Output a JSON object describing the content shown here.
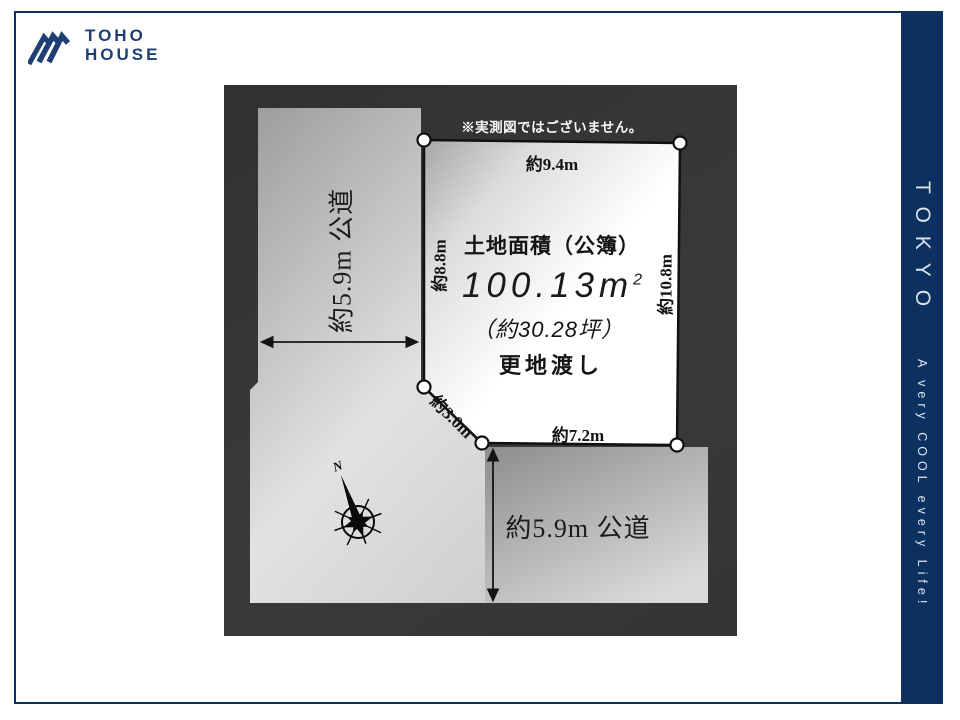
{
  "page": {
    "brand": {
      "name_line1": "TOHO",
      "name_line2": "HOUSE"
    },
    "side_band": {
      "title": "TOKYO",
      "tagline": "A very COOL every Life!"
    },
    "colors": {
      "navy_band": "#0c3060",
      "logo_navy": "#1e4075",
      "panel_charcoal": "#353535",
      "plot_white": "#ffffff",
      "road_gray": "#c0c0c0",
      "outline_black": "#141414"
    },
    "diagram": {
      "disclaimer": "※実測図ではございません。",
      "area_title": "土地面積（公簿）",
      "area_value": "100.13",
      "area_unit": "m",
      "area_sup": "2",
      "area_tsubo": "（約30.28坪）",
      "delivery": "更地渡し",
      "dims": {
        "top": "約9.4m",
        "left": "約8.8m",
        "right": "約10.8m",
        "diagonal": "約3.0m",
        "bottom": "約7.2m"
      },
      "roads": {
        "left": "約5.9m 公道",
        "bottom": "約5.9m 公道"
      },
      "compass_label": "N"
    }
  }
}
